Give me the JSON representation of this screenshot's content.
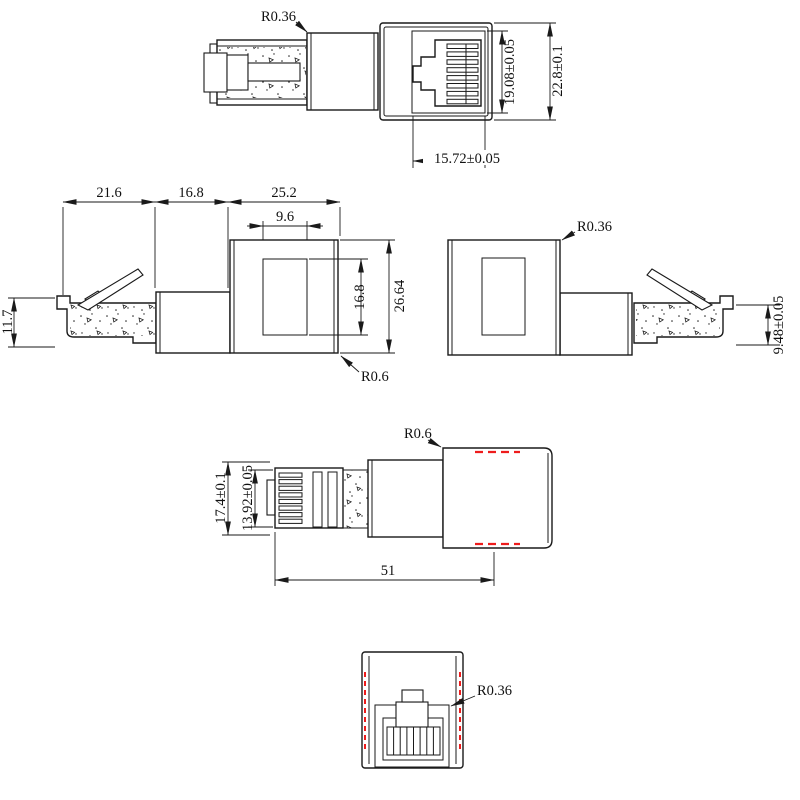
{
  "meta": {
    "background": "#ffffff",
    "line_color": "#1a1a1a",
    "hidden_line_color": "#ee1c1c"
  },
  "views": {
    "top": {
      "dims": {
        "radius": "R0.36",
        "inner_height": "19.08±0.05",
        "outer_height": "22.8±0.1",
        "inner_width": "15.72±0.05"
      }
    },
    "middle_left": {
      "dims": {
        "plug_length": "21.6",
        "barrel_length": "16.8",
        "body_length": "25.2",
        "window_width": "9.6",
        "plug_height": "11.7",
        "window_height": "16.8",
        "body_height": "26.64",
        "radius": "R0.6"
      }
    },
    "middle_right": {
      "dims": {
        "radius": "R0.36",
        "plug_thickness": "9.48±0.05"
      }
    },
    "plan": {
      "dims": {
        "overall_width": "17.4±0.1",
        "plug_width": "13.92±0.05",
        "overall_length": "51",
        "radius": "R0.6"
      }
    },
    "bottom": {
      "dims": {
        "radius": "R0.36"
      }
    }
  }
}
